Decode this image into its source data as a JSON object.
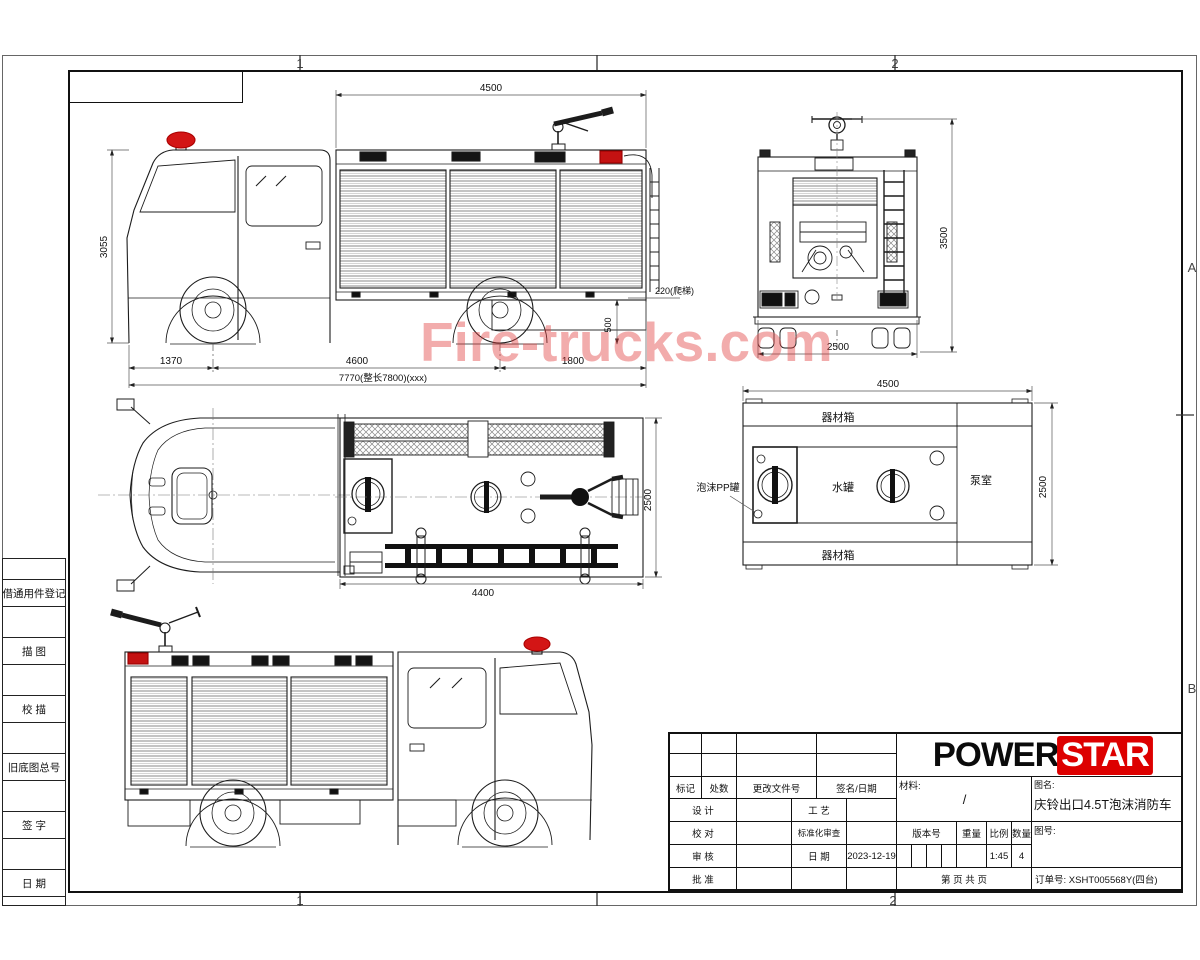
{
  "watermark": {
    "text": "Fire-trucks.com",
    "color": "#e03a3a"
  },
  "frame": {
    "zone_col_1": "1",
    "zone_col_2": "2",
    "zone_row_a": "A",
    "zone_row_b": "B"
  },
  "sidebar": {
    "labels": [
      "借通用件登记",
      "描 图",
      "校 描",
      "旧底图总号",
      "签 字",
      "日 期"
    ]
  },
  "dims": {
    "side": {
      "len": "4500",
      "height": "3055",
      "front": "1370",
      "wheelbase": "4600",
      "rear": "1800",
      "overall": "7770(整长7800)(xxx)",
      "ladder": "220(爬梯)",
      "rearh": "500"
    },
    "rear": {
      "height": "3500",
      "width": "2500"
    },
    "top": {
      "width": "2500",
      "length": "4400"
    },
    "plan": {
      "length": "4500",
      "width": "2500"
    }
  },
  "plan_labels": {
    "top_box": "器材箱",
    "foam_tank": "泡沫PP罐",
    "water_tank": "水罐",
    "pump_room": "泵室",
    "bottom_box": "器材箱"
  },
  "title_block": {
    "logo_power": "POWER",
    "logo_star": "STAR",
    "mark": "标记",
    "count": "处数",
    "change_doc": "更改文件号",
    "sign_date": "签名/日期",
    "design": "设 计",
    "process": "工 艺",
    "check": "校 对",
    "standard": "标准化审查",
    "review": "审 核",
    "date_label": "日 期",
    "date_value": "2023-12-19",
    "approve": "批 准",
    "material_label": "材料:",
    "material_value": "/",
    "name_label": "图名:",
    "name_value": "庆铃出口4.5T泡沫消防车",
    "version_label": "版本号",
    "weight_label": "重量",
    "scale_label": "比例",
    "qty_label": "数量",
    "scale_value": "1:45",
    "qty_value": "4",
    "no_label": "图号:",
    "sheet_label": "第  页   共  页",
    "order_label": "订单号:",
    "order_value": "XSHT005568Y(四台)"
  }
}
